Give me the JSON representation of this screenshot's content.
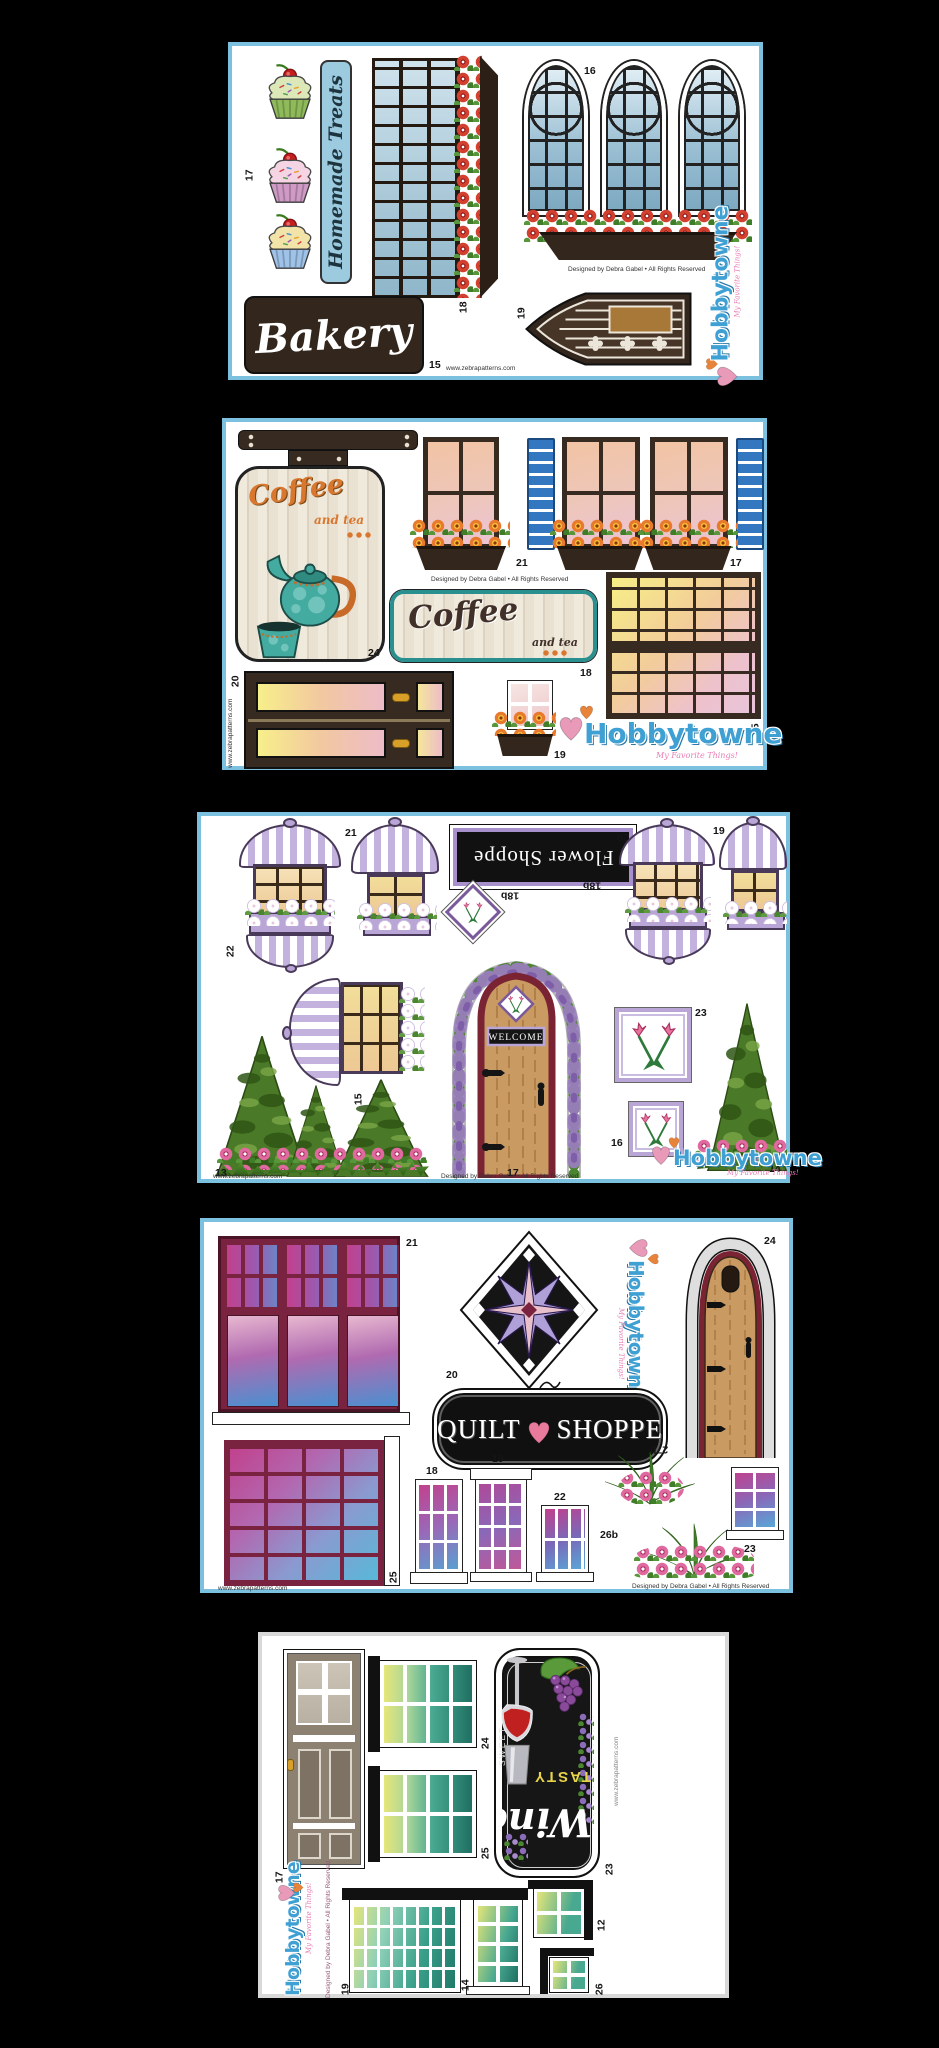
{
  "branding": {
    "logo_text": "Hobbytowne",
    "logo_tagline": "My Favorite Things!",
    "credit": "Designed by Debra Gabel • All Rights Reserved",
    "website": "www.zebrapatterns.com"
  },
  "sheets": {
    "bakery": {
      "side_sign": "Homemade Treats",
      "main_sign": "Bakery",
      "labels": {
        "cupcakes": "17",
        "arch_windows": "16",
        "storefront": "18",
        "door": "19",
        "sign": "15"
      }
    },
    "coffee": {
      "sign_word": "Coffee",
      "sign_sub": "and tea",
      "labels": {
        "hanging_sign": "24",
        "window_left": "21",
        "window_right": "17",
        "flat_sign": "18",
        "grid_window": "15",
        "double_door": "20",
        "small_window": "19"
      }
    },
    "flower": {
      "sign": "Flower Shoppe",
      "welcome": "WELCOME",
      "labels": {
        "awning_left": "21",
        "awning_left_inverted": "22",
        "awning_right_inverted": "20",
        "awning_right": "19",
        "diamond_left": "18b",
        "diamond_right": "18b",
        "awning_rotated": "15",
        "door": "17",
        "quilt_block_large": "23",
        "quilt_block_small": "16",
        "topiary_group": "13",
        "topiary_single": "14"
      }
    },
    "quilt": {
      "sign_word1": "QUILT",
      "sign_word2": "SHOPPE",
      "labels": {
        "triple_window": "21",
        "star_block": "20",
        "door": "24",
        "grid_window": "25",
        "window_a": "18",
        "window_b": "19",
        "window_c": "22",
        "hanging_basket": "27b",
        "flower_bush": "26b",
        "window_d": "23"
      }
    },
    "wine": {
      "sign_script": "Wine",
      "sign_tasty": "TASTY",
      "sign_sweet": "SWEET",
      "labels": {
        "door": "17",
        "window_a": "24",
        "window_b": "25",
        "sign": "23",
        "grid_window": "19",
        "window_c": "14",
        "window_d": "12",
        "window_e": "26"
      }
    }
  }
}
